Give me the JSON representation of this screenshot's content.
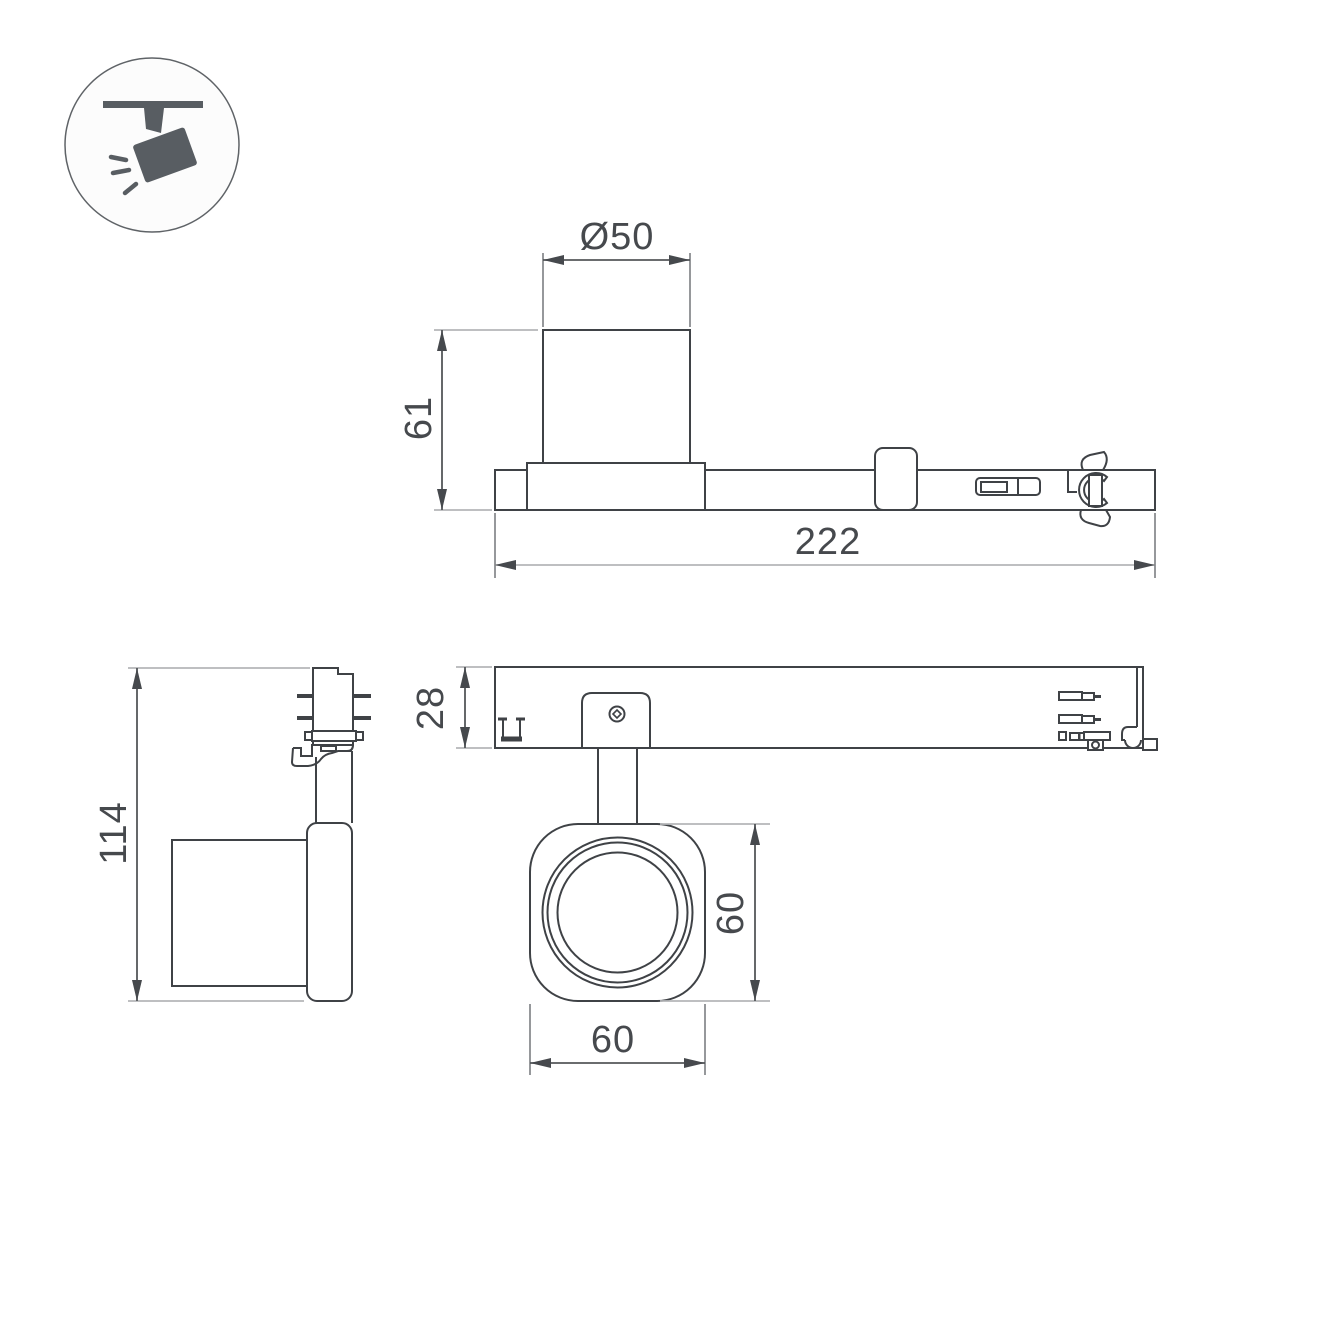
{
  "icon": {
    "name": "track-spotlight-pictogram",
    "fill_color": "#585d62",
    "circle_stroke": "#5f6367"
  },
  "dimensions": {
    "side_view": {
      "diameter": "Ø50",
      "height": "61",
      "length": "222"
    },
    "front_view": {
      "overall_height": "114"
    },
    "top_view": {
      "body_depth": "28",
      "head_height": "60",
      "head_width": "60"
    }
  },
  "colors": {
    "object_line": "#3f4246",
    "dimension_line": "#54575a",
    "extension_line_light": "#b4b6b8",
    "extension_line_medium": "#8a8d90",
    "arrow_and_text": "#46494d",
    "background": "#ffffff"
  }
}
